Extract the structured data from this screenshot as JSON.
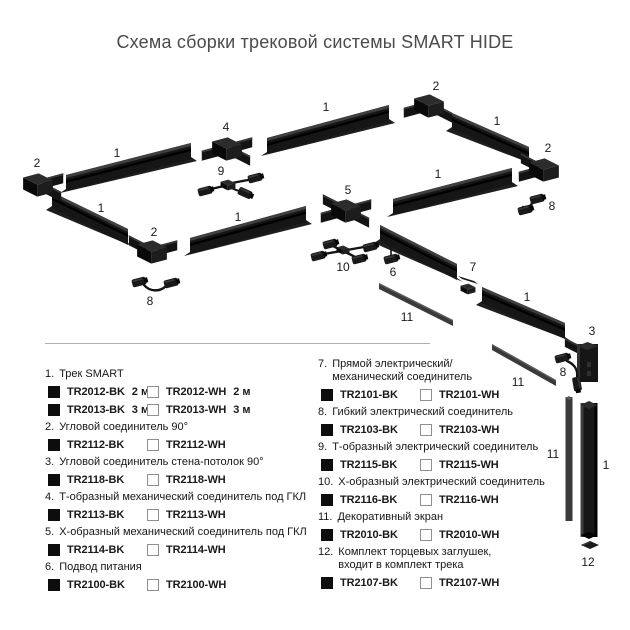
{
  "title": "Схема сборки трековой системы SMART HIDE",
  "colors": {
    "title_text": "#4b4b4b",
    "divider": "#b0b0b0",
    "track_body": "#161616",
    "track_highlight": "#3f3f3f",
    "track_groove": "#000000",
    "track_base": "#1e1e1e",
    "screen": "#3a3a3a",
    "screen_highlight": "#5c5c5c",
    "connector": "#131313",
    "cube_top": "#2c2c2c",
    "cube_left": "#090909",
    "cube_right": "#1d1d1d",
    "label_text": "#1a1a1a",
    "swatch_black": "#0d0d0d",
    "swatch_white_border": "#8f8f8f"
  },
  "diagram": {
    "labels": [
      {
        "text": "2",
        "x": 37,
        "y": 163
      },
      {
        "text": "1",
        "x": 117,
        "y": 153
      },
      {
        "text": "4",
        "x": 226,
        "y": 127
      },
      {
        "text": "1",
        "x": 326,
        "y": 107
      },
      {
        "text": "2",
        "x": 436,
        "y": 86
      },
      {
        "text": "1",
        "x": 497,
        "y": 121
      },
      {
        "text": "2",
        "x": 548,
        "y": 148
      },
      {
        "text": "9",
        "x": 221,
        "y": 171
      },
      {
        "text": "8",
        "x": 552,
        "y": 206
      },
      {
        "text": "1",
        "x": 101,
        "y": 208
      },
      {
        "text": "5",
        "x": 348,
        "y": 190
      },
      {
        "text": "1",
        "x": 238,
        "y": 217
      },
      {
        "text": "2",
        "x": 154,
        "y": 232
      },
      {
        "text": "1",
        "x": 438,
        "y": 174
      },
      {
        "text": "10",
        "x": 343,
        "y": 267
      },
      {
        "text": "6",
        "x": 393,
        "y": 272
      },
      {
        "text": "7",
        "x": 473,
        "y": 267
      },
      {
        "text": "8",
        "x": 150,
        "y": 301
      },
      {
        "text": "11",
        "x": 407,
        "y": 317
      },
      {
        "text": "1",
        "x": 527,
        "y": 297
      },
      {
        "text": "3",
        "x": 592,
        "y": 331
      },
      {
        "text": "8",
        "x": 563,
        "y": 372
      },
      {
        "text": "11",
        "x": 518,
        "y": 382
      },
      {
        "text": "11",
        "x": 553,
        "y": 454
      },
      {
        "text": "1",
        "x": 606,
        "y": 465
      },
      {
        "text": "12",
        "x": 588,
        "y": 562
      }
    ]
  },
  "legend": {
    "columns": [
      {
        "items": [
          {
            "num": "1.",
            "title": "Трек SMART",
            "title2": "",
            "rows": [
              {
                "bk": "TR2012-BK",
                "bk_note": "2 м",
                "wh": "TR2012-WH",
                "wh_note": "2 м"
              },
              {
                "bk": "TR2013-BK",
                "bk_note": "3 м",
                "wh": "TR2013-WH",
                "wh_note": "3 м"
              }
            ]
          },
          {
            "num": "2.",
            "title": "Угловой соединитель 90°",
            "title2": "",
            "rows": [
              {
                "bk": "TR2112-BK",
                "bk_note": "",
                "wh": "TR2112-WH",
                "wh_note": ""
              }
            ]
          },
          {
            "num": "3.",
            "title": "Угловой соединитель стена-потолок 90°",
            "title2": "",
            "rows": [
              {
                "bk": "TR2118-BK",
                "bk_note": "",
                "wh": "TR2118-WH",
                "wh_note": ""
              }
            ]
          },
          {
            "num": "4.",
            "title": "Т-образный механический соединитель под ГКЛ",
            "title2": "",
            "rows": [
              {
                "bk": "TR2113-BK",
                "bk_note": "",
                "wh": "TR2113-WH",
                "wh_note": ""
              }
            ]
          },
          {
            "num": "5.",
            "title": "Х-образный механический соединитель под ГКЛ",
            "title2": "",
            "rows": [
              {
                "bk": "TR2114-BK",
                "bk_note": "",
                "wh": "TR2114-WH",
                "wh_note": ""
              }
            ]
          },
          {
            "num": "6.",
            "title": "Подвод питания",
            "title2": "",
            "rows": [
              {
                "bk": "TR2100-BK",
                "bk_note": "",
                "wh": "TR2100-WH",
                "wh_note": ""
              }
            ]
          }
        ]
      },
      {
        "items": [
          {
            "num": "7.",
            "title": "Прямой электрический/",
            "title2": "механический соединитель",
            "rows": [
              {
                "bk": "TR2101-BK",
                "bk_note": "",
                "wh": "TR2101-WH",
                "wh_note": ""
              }
            ]
          },
          {
            "num": "8.",
            "title": "Гибкий электрический соединитель",
            "title2": "",
            "rows": [
              {
                "bk": "TR2103-BK",
                "bk_note": "",
                "wh": "TR2103-WH",
                "wh_note": ""
              }
            ]
          },
          {
            "num": "9.",
            "title": "Т-образный электрический соединитель",
            "title2": "",
            "rows": [
              {
                "bk": "TR2115-BK",
                "bk_note": "",
                "wh": "TR2115-WH",
                "wh_note": ""
              }
            ]
          },
          {
            "num": "10.",
            "title": "Х-образный электрический соединитель",
            "title2": "",
            "rows": [
              {
                "bk": "TR2116-BK",
                "bk_note": "",
                "wh": "TR2116-WH",
                "wh_note": ""
              }
            ]
          },
          {
            "num": "11.",
            "title": "Декоративный экран",
            "title2": "",
            "rows": [
              {
                "bk": "TR2010-BK",
                "bk_note": "",
                "wh": "TR2010-WH",
                "wh_note": ""
              }
            ]
          },
          {
            "num": "12.",
            "title": "Комплект торцевых заглушек,",
            "title2": "входит в комплект трека",
            "rows": [
              {
                "bk": "TR2107-BK",
                "bk_note": "",
                "wh": "TR2107-WH",
                "wh_note": ""
              }
            ]
          }
        ]
      }
    ]
  }
}
